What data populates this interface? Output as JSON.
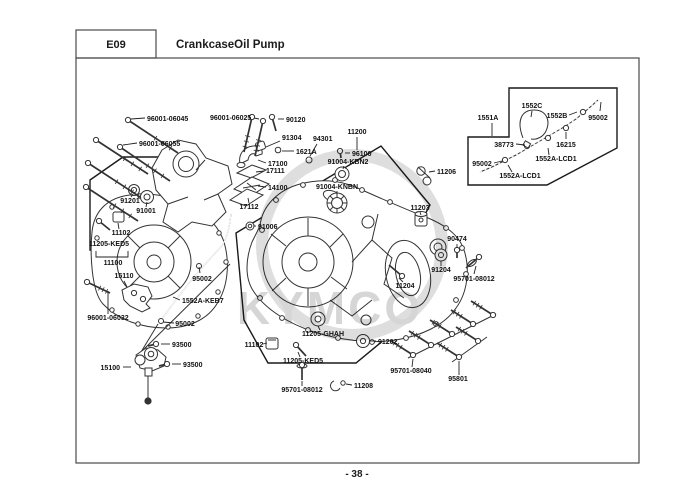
{
  "header": {
    "code": "E09",
    "title": "CrankcaseOil Pump"
  },
  "footer": {
    "page_number": "- 38 -"
  },
  "watermark": {
    "text": "KYMCO"
  },
  "colors": {
    "line": "#333333",
    "label": "#111111",
    "watermark": "#d6d6d6",
    "background": "#ffffff"
  },
  "diagram": {
    "labels": [
      {
        "t": "96001-06045",
        "x": 147,
        "y": 121,
        "a": "start",
        "l": [
          [
            145,
            118
          ],
          [
            131,
            119
          ]
        ]
      },
      {
        "t": "96001-06055",
        "x": 139,
        "y": 146,
        "a": "start",
        "l": [
          [
            137,
            143
          ],
          [
            123,
            145
          ]
        ]
      },
      {
        "t": "96001-06025",
        "x": 210,
        "y": 120,
        "a": "start",
        "l": [
          [
            254,
            118
          ],
          [
            259,
            119
          ]
        ]
      },
      {
        "t": "90120",
        "x": 286,
        "y": 122,
        "a": "start",
        "l": [
          [
            284,
            119
          ],
          [
            278,
            119
          ]
        ]
      },
      {
        "t": "91304",
        "x": 282,
        "y": 140,
        "a": "start",
        "l": [
          [
            280,
            141
          ],
          [
            266,
            147
          ]
        ]
      },
      {
        "t": "1621A",
        "x": 296,
        "y": 154,
        "a": "start",
        "l": [
          [
            294,
            151
          ],
          [
            282,
            151
          ]
        ]
      },
      {
        "t": "94301",
        "x": 313,
        "y": 141,
        "a": "start",
        "l": [
          [
            317,
            144
          ],
          [
            310,
            156
          ]
        ]
      },
      {
        "t": "17100",
        "x": 268,
        "y": 166,
        "a": "start",
        "l": [
          [
            266,
            163
          ],
          [
            258,
            160
          ]
        ]
      },
      {
        "t": "17111",
        "x": 266,
        "y": 173,
        "a": "start",
        "l": [
          [
            264,
            171
          ],
          [
            256,
            172
          ]
        ]
      },
      {
        "t": "14100",
        "x": 268,
        "y": 190,
        "a": "start",
        "l": [
          [
            266,
            187
          ],
          [
            258,
            186
          ]
        ]
      },
      {
        "t": "17112",
        "x": 249,
        "y": 209,
        "a": "middle",
        "l": [
          [
            249,
            203
          ],
          [
            248,
            198
          ]
        ]
      },
      {
        "t": "91006",
        "x": 258,
        "y": 229,
        "a": "start",
        "l": [
          [
            256,
            226
          ],
          [
            254,
            226
          ]
        ]
      },
      {
        "t": "11200",
        "x": 357,
        "y": 134,
        "a": "middle",
        "l": [
          [
            357,
            137
          ],
          [
            357,
            150
          ]
        ]
      },
      {
        "t": "96100",
        "x": 352,
        "y": 156,
        "a": "start",
        "l": [
          [
            350,
            153
          ],
          [
            345,
            153
          ]
        ]
      },
      {
        "t": "91004-KBN2",
        "x": 348,
        "y": 164,
        "a": "middle",
        "l": [
          [
            344,
            166
          ],
          [
            343,
            169
          ]
        ]
      },
      {
        "t": "91004-KNBN",
        "x": 337,
        "y": 189,
        "a": "middle",
        "l": [
          [
            337,
            191
          ],
          [
            337,
            195
          ]
        ]
      },
      {
        "t": "11206",
        "x": 437,
        "y": 174,
        "a": "start",
        "l": [
          [
            435,
            171
          ],
          [
            429,
            172
          ]
        ]
      },
      {
        "t": "11203",
        "x": 420,
        "y": 210,
        "a": "middle",
        "l": [
          [
            420,
            212
          ],
          [
            421,
            215
          ]
        ]
      },
      {
        "t": "90474",
        "x": 457,
        "y": 241,
        "a": "middle",
        "l": [
          [
            457,
            244
          ],
          [
            457,
            248
          ]
        ]
      },
      {
        "t": "91204",
        "x": 441,
        "y": 272,
        "a": "middle",
        "l": [
          [
            441,
            266
          ],
          [
            441,
            261
          ]
        ]
      },
      {
        "t": "95701-08012",
        "x": 474,
        "y": 281,
        "a": "middle",
        "l": [
          [
            474,
            274
          ],
          [
            476,
            266
          ]
        ]
      },
      {
        "t": "11204",
        "x": 405,
        "y": 288,
        "a": "middle",
        "l": [
          [
            403,
            282
          ],
          [
            399,
            278
          ]
        ]
      },
      {
        "t": "1551A",
        "x": 488,
        "y": 120,
        "a": "middle",
        "l": [
          [
            492,
            123
          ],
          [
            492,
            136
          ]
        ]
      },
      {
        "t": "1552C",
        "x": 532,
        "y": 108,
        "a": "middle",
        "l": [
          [
            532,
            111
          ],
          [
            531,
            117
          ]
        ]
      },
      {
        "t": "1552B",
        "x": 557,
        "y": 118,
        "a": "middle",
        "l": [
          [
            569,
            115
          ],
          [
            577,
            112
          ]
        ]
      },
      {
        "t": "95002",
        "x": 598,
        "y": 120,
        "a": "middle",
        "l": [
          [
            600,
            111
          ],
          [
            601,
            102
          ]
        ]
      },
      {
        "t": "38773",
        "x": 504,
        "y": 147,
        "a": "middle",
        "l": [
          [
            516,
            144
          ],
          [
            525,
            145
          ]
        ]
      },
      {
        "t": "16215",
        "x": 566,
        "y": 147,
        "a": "middle",
        "l": [
          [
            566,
            139
          ],
          [
            566,
            132
          ]
        ]
      },
      {
        "t": "1552A-LCD1",
        "x": 556,
        "y": 161,
        "a": "middle",
        "l": [
          [
            549,
            155
          ],
          [
            548,
            148
          ]
        ]
      },
      {
        "t": "95002",
        "x": 482,
        "y": 166,
        "a": "middle",
        "l": [
          [
            494,
            163
          ],
          [
            502,
            161
          ]
        ]
      },
      {
        "t": "1552A-LCD1",
        "x": 520,
        "y": 178,
        "a": "middle",
        "l": [
          [
            512,
            172
          ],
          [
            508,
            165
          ]
        ]
      },
      {
        "t": "91201",
        "x": 130,
        "y": 203,
        "a": "middle",
        "l": [
          [
            131,
            197
          ],
          [
            133,
            194
          ]
        ]
      },
      {
        "t": "91001",
        "x": 146,
        "y": 213,
        "a": "middle",
        "l": [
          [
            146,
            207
          ],
          [
            147,
            202
          ]
        ]
      },
      {
        "t": "11102",
        "x": 121,
        "y": 235,
        "a": "middle",
        "l": [
          [
            119,
            229
          ],
          [
            118,
            223
          ]
        ]
      },
      {
        "t": "11205-KED5",
        "x": 109,
        "y": 246,
        "a": "middle"
      },
      {
        "t": "11100",
        "x": 113,
        "y": 265,
        "a": "middle",
        "l": [
          [
            96,
            251
          ],
          [
            96,
            257
          ],
          [
            128,
            257
          ],
          [
            128,
            251
          ]
        ]
      },
      {
        "t": "15110",
        "x": 124,
        "y": 278,
        "a": "middle",
        "l": [
          [
            124,
            281
          ],
          [
            127,
            287
          ]
        ]
      },
      {
        "t": "95002",
        "x": 202,
        "y": 281,
        "a": "middle",
        "l": [
          [
            200,
            273
          ],
          [
            199,
            267
          ]
        ]
      },
      {
        "t": "1552A-KEB7",
        "x": 182,
        "y": 303,
        "a": "start",
        "l": [
          [
            180,
            300
          ],
          [
            173,
            297
          ]
        ]
      },
      {
        "t": "96001-06032",
        "x": 108,
        "y": 320,
        "a": "middle",
        "l": [
          [
            108,
            314
          ],
          [
            108,
            291
          ]
        ]
      },
      {
        "t": "95002",
        "x": 185,
        "y": 326,
        "a": "middle",
        "l": [
          [
            174,
            323
          ],
          [
            163,
            322
          ]
        ]
      },
      {
        "t": "93500",
        "x": 172,
        "y": 347,
        "a": "start",
        "l": [
          [
            170,
            344
          ],
          [
            161,
            344
          ]
        ]
      },
      {
        "t": "93500",
        "x": 183,
        "y": 367,
        "a": "start",
        "l": [
          [
            181,
            364
          ],
          [
            172,
            364
          ]
        ]
      },
      {
        "t": "15100",
        "x": 120,
        "y": 370,
        "a": "end",
        "l": [
          [
            123,
            367
          ],
          [
            131,
            367
          ]
        ]
      },
      {
        "t": "11102",
        "x": 254,
        "y": 347,
        "a": "middle",
        "l": [
          [
            263,
            344
          ],
          [
            267,
            343
          ]
        ]
      },
      {
        "t": "11205-GHAH",
        "x": 323,
        "y": 336,
        "a": "middle",
        "l": [
          [
            320,
            330
          ],
          [
            318,
            326
          ]
        ]
      },
      {
        "t": "11205-KED5",
        "x": 303,
        "y": 363,
        "a": "middle",
        "l": [
          [
            300,
            357
          ],
          [
            298,
            352
          ]
        ]
      },
      {
        "t": "91202",
        "x": 378,
        "y": 344,
        "a": "start",
        "l": [
          [
            376,
            341
          ],
          [
            370,
            341
          ]
        ]
      },
      {
        "t": "95701-08012",
        "x": 302,
        "y": 392,
        "a": "middle",
        "l": [
          [
            302,
            386
          ],
          [
            302,
            381
          ]
        ]
      },
      {
        "t": "11208",
        "x": 354,
        "y": 388,
        "a": "start",
        "l": [
          [
            352,
            385
          ],
          [
            346,
            384
          ]
        ]
      },
      {
        "t": "95701-08040",
        "x": 411,
        "y": 373,
        "a": "middle",
        "l": [
          [
            412,
            367
          ],
          [
            413,
            359
          ]
        ]
      },
      {
        "t": "95801",
        "x": 458,
        "y": 381,
        "a": "middle",
        "l": [
          [
            459,
            375
          ],
          [
            459,
            361
          ]
        ]
      }
    ]
  }
}
